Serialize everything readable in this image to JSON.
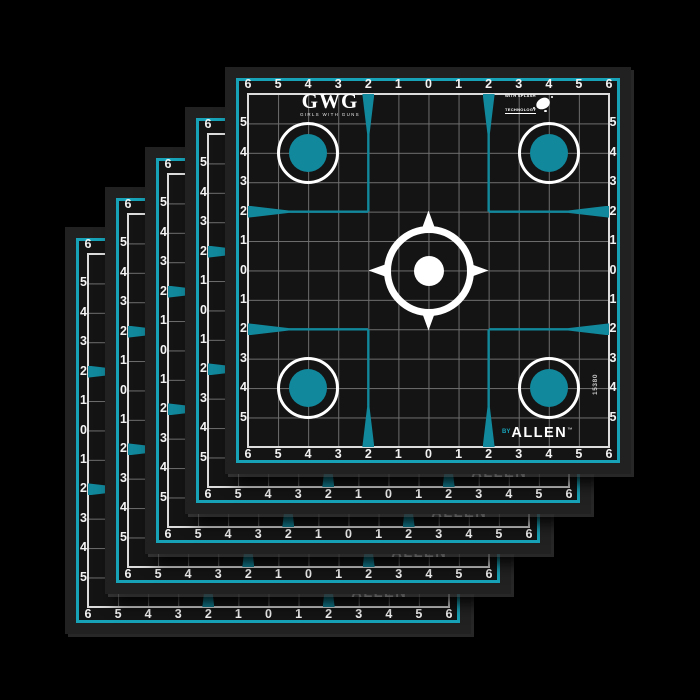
{
  "product": {
    "brand": "GWG",
    "brand_subtitle": "GIRLS WITH GUNS",
    "splash_badge_line1": "WITH SPLASH",
    "splash_badge_line2": "TECHNOLOGY",
    "maker_prefix": "BY",
    "maker_name": "ALLEN",
    "maker_trademark": "™",
    "item_number": "15380"
  },
  "target_sheet": {
    "axis_top": [
      "6",
      "5",
      "4",
      "3",
      "2",
      "1",
      "0",
      "1",
      "2",
      "3",
      "4",
      "5",
      "6"
    ],
    "axis_bottom": [
      "6",
      "5",
      "4",
      "3",
      "2",
      "1",
      "0",
      "1",
      "2",
      "3",
      "4",
      "5",
      "6"
    ],
    "axis_left": [
      "5",
      "4",
      "3",
      "2",
      "1",
      "0",
      "1",
      "2",
      "3",
      "4",
      "5"
    ],
    "axis_right": [
      "5",
      "4",
      "3",
      "2",
      "1",
      "0",
      "1",
      "2",
      "3",
      "4",
      "5"
    ],
    "grid_units_per_side": 12,
    "bullseye_positions": [
      "top-left",
      "top-right",
      "bottom-left",
      "bottom-right"
    ],
    "corner_mark_offset_units": 2
  },
  "stack": {
    "sheet_count": 5,
    "offset_px": 40,
    "front_left_px": 225,
    "front_top_px": 67
  },
  "colors": {
    "teal_accent": "#11889c",
    "teal_border": "#17a2b8",
    "sheet_black": "#141414",
    "frame_black": "#212121",
    "grid_line_gray": "#6e6e6e",
    "grid_edge_white": "#dcdcdc",
    "number_white": "#f2f2f2",
    "background": "#000000"
  }
}
